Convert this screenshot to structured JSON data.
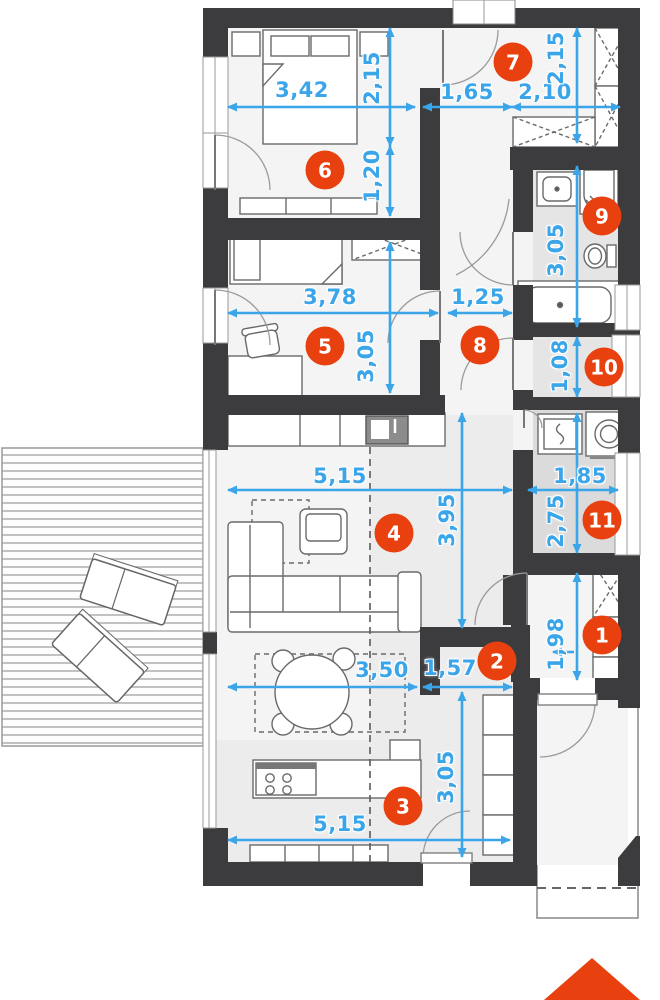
{
  "plan": {
    "badges": [
      {
        "number": "1"
      },
      {
        "number": "2"
      },
      {
        "number": "3"
      },
      {
        "number": "4"
      },
      {
        "number": "5"
      },
      {
        "number": "6"
      },
      {
        "number": "7"
      },
      {
        "number": "8"
      },
      {
        "number": "9"
      },
      {
        "number": "10"
      },
      {
        "number": "11"
      }
    ],
    "dimensions": [
      {
        "label": "3,42"
      },
      {
        "label": "2,15"
      },
      {
        "label": "1,65"
      },
      {
        "label": "2,10"
      },
      {
        "label": "2,15"
      },
      {
        "label": "1,20"
      },
      {
        "label": "3,78"
      },
      {
        "label": "1,25"
      },
      {
        "label": "3,05"
      },
      {
        "label": "3,05"
      },
      {
        "label": "1,08"
      },
      {
        "label": "5,15"
      },
      {
        "label": "1,85"
      },
      {
        "label": "3,95"
      },
      {
        "label": "2,75"
      },
      {
        "label": "1,98"
      },
      {
        "label": "3,50"
      },
      {
        "label": "1,57"
      },
      {
        "label": "3,05"
      },
      {
        "label": "5,15"
      }
    ],
    "colors": {
      "badge": "#e8400e",
      "dimension": "#3aa5e8",
      "wall": "#3c3c3e"
    },
    "icons": {
      "entrance_arrow": "up-triangle"
    }
  }
}
